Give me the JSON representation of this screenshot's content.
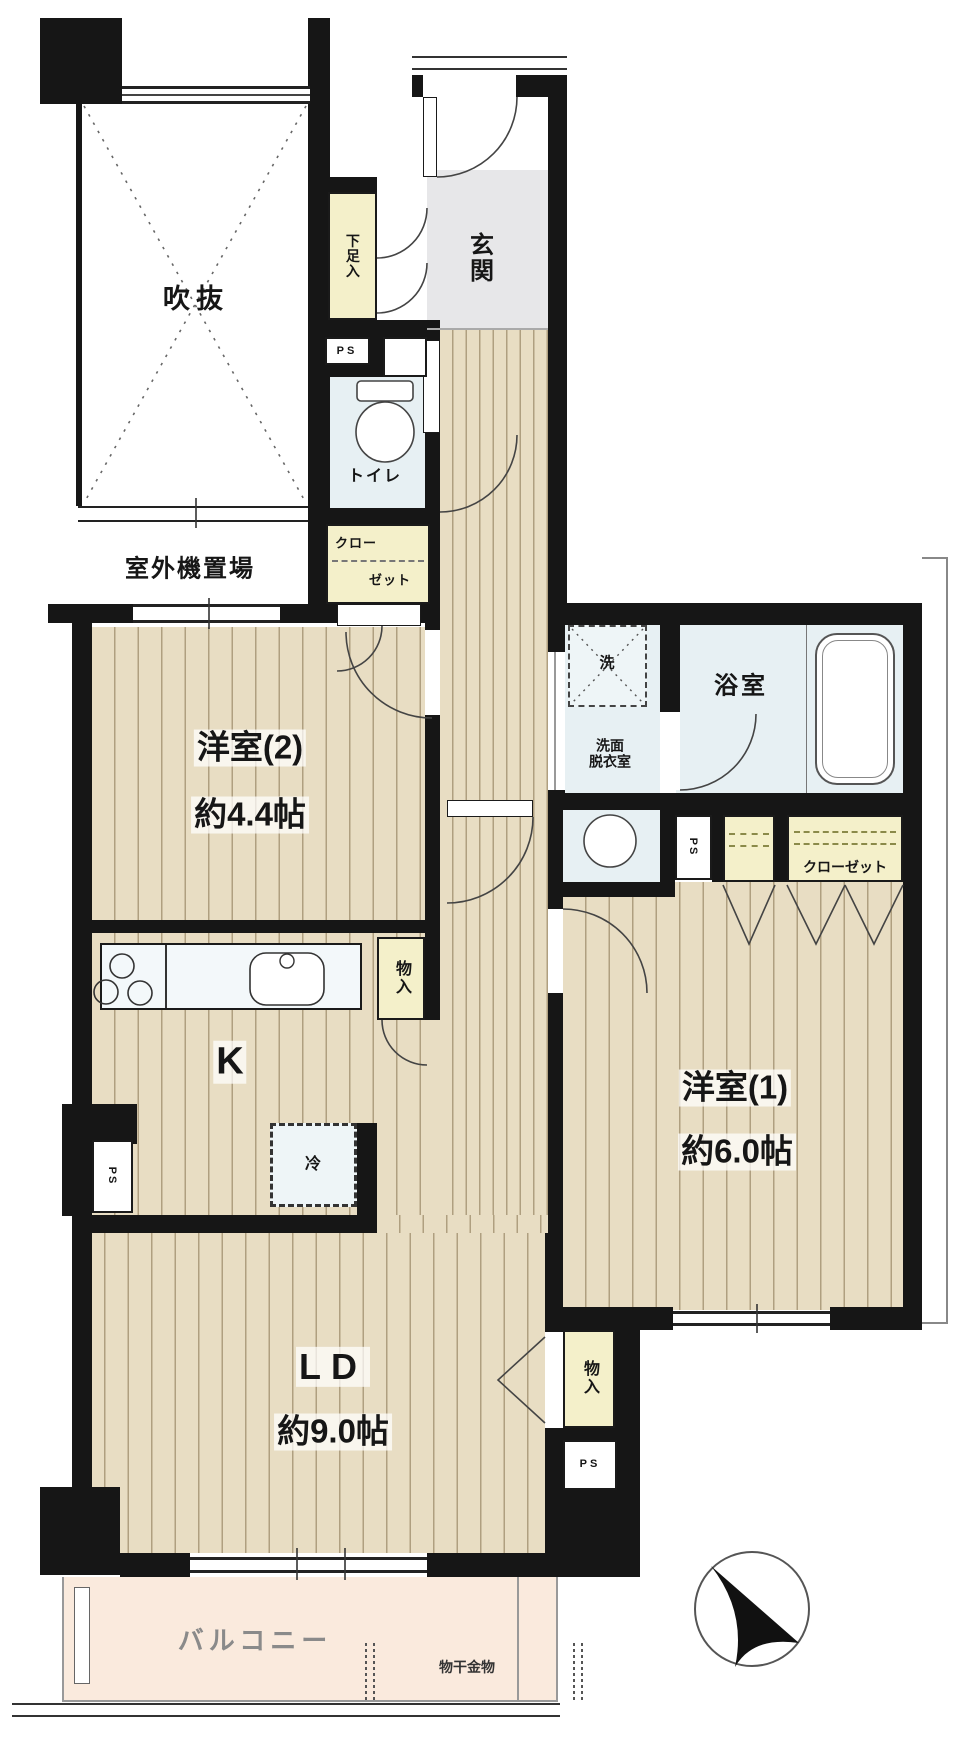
{
  "document": {
    "kind": "apartment-floor-plan"
  },
  "labels": {
    "void": "吹抜",
    "outdoor_unit": "室外機置場",
    "entrance": "玄関",
    "shoe_box": "下足入",
    "ps": "PS",
    "toilet": "トイレ",
    "closet_l1": "クロー",
    "closet_l2": "ゼット",
    "room2_name": "洋室(2)",
    "room2_size": "約4.4帖",
    "washer": "洗",
    "bathroom": "浴室",
    "washroom_l1": "洗面",
    "washroom_l2": "脱衣室",
    "closet": "クローゼット",
    "kitchen": "K",
    "fridge": "冷",
    "storage": "物入",
    "room1_name": "洋室(1)",
    "room1_size": "約6.0帖",
    "ld_name": "LD",
    "ld_size": "約9.0帖",
    "balcony": "バルコニー",
    "laundry_hardware": "物干金物"
  },
  "colors": {
    "wall": "#161616",
    "flooring": "#e8ddc3",
    "flooring_stripe": "#9c8b68",
    "wet_area_tile": "#e7f0f3",
    "closet_yellow": "#f4f0ca",
    "entrance_gray": "#e7e7e9",
    "balcony_pink": "#faeadd",
    "compass_arrow": "#111111"
  }
}
